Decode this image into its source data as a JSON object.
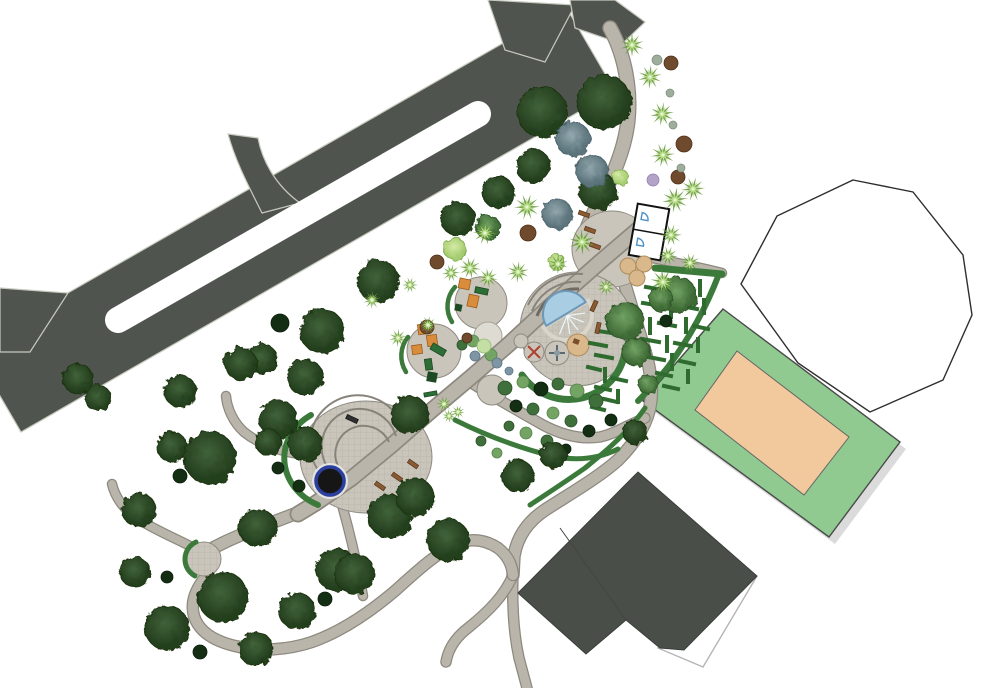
{
  "meta": {
    "image_type": "landscape-architecture site plan, top-down rendered park design",
    "visible_text": [],
    "features": [
      "divided road with median",
      "park entry path",
      "restroom pavilion",
      "picnic tables",
      "splash pool plaza with amphitheater steps",
      "spinner play circles",
      "sand circle",
      "two playground pads with climbers",
      "hedge maze garden",
      "shrub garden",
      "large oval plaza with round black pond",
      "small round plaza",
      "looping walking trails",
      "sports court (green with tan infield)",
      "large dark hip-roof building",
      "white parcel outline",
      "dense tree planting"
    ]
  },
  "colors": {
    "road": "#50544f",
    "road_edge": "#c6cabd",
    "path_fill": "#b9b5ab",
    "path_edge": "#8d897f",
    "plaza_fill": "#c9c5bb",
    "plaza_edge": "#8f8b82",
    "hedge": "#3c7a3c",
    "maze_wall": "#2f6b2f",
    "field_green": "#90ca90",
    "court_tan": "#f1c99d",
    "building_roof": "#4a4e49",
    "water": "#a9cde2",
    "water_edge": "#6d98b8",
    "pond": "#161616",
    "pond_ring": "#2b3f9e",
    "bench": "#8a5a33",
    "equip_orange": "#d88c3c",
    "equip_green": "#2c6e36",
    "tree_dark": "#2c4c28",
    "tree_medium": "#4d7d46",
    "tree_blue": "#6e858d",
    "palm": "#9ccb66",
    "white": "#ffffff"
  },
  "vegetation": {
    "trees": [
      [
        542,
        112,
        25,
        "d"
      ],
      [
        604,
        102,
        27,
        "d"
      ],
      [
        533,
        166,
        17,
        "d"
      ],
      [
        598,
        191,
        19,
        "d"
      ],
      [
        498,
        192,
        16,
        "d"
      ],
      [
        458,
        219,
        17,
        "d"
      ],
      [
        378,
        281,
        21,
        "d"
      ],
      [
        322,
        331,
        22,
        "d"
      ],
      [
        305,
        377,
        18,
        "d"
      ],
      [
        262,
        359,
        15,
        "d"
      ],
      [
        241,
        364,
        16,
        "d"
      ],
      [
        180,
        391,
        16,
        "d"
      ],
      [
        78,
        379,
        15,
        "d"
      ],
      [
        98,
        398,
        13,
        "d"
      ],
      [
        172,
        447,
        15,
        "d"
      ],
      [
        210,
        458,
        26,
        "d"
      ],
      [
        278,
        419,
        19,
        "d"
      ],
      [
        139,
        510,
        17,
        "d"
      ],
      [
        135,
        572,
        15,
        "d"
      ],
      [
        167,
        628,
        22,
        "d"
      ],
      [
        223,
        597,
        25,
        "d"
      ],
      [
        256,
        649,
        17,
        "d"
      ],
      [
        297,
        611,
        18,
        "d"
      ],
      [
        337,
        570,
        21,
        "d"
      ],
      [
        390,
        516,
        22,
        "d"
      ],
      [
        415,
        497,
        19,
        "d"
      ],
      [
        448,
        540,
        21,
        "d"
      ],
      [
        258,
        528,
        19,
        "d"
      ],
      [
        305,
        444,
        17,
        "d"
      ],
      [
        268,
        442,
        13,
        "d"
      ],
      [
        410,
        415,
        19,
        "d"
      ],
      [
        518,
        476,
        16,
        "d"
      ],
      [
        553,
        455,
        13,
        "d"
      ],
      [
        635,
        432,
        12,
        "d"
      ],
      [
        355,
        574,
        20,
        "d"
      ],
      [
        573,
        139,
        17,
        "b"
      ],
      [
        592,
        171,
        16,
        "b"
      ],
      [
        557,
        214,
        15,
        "b"
      ],
      [
        488,
        227,
        12,
        "m"
      ],
      [
        625,
        321,
        19,
        "m"
      ],
      [
        678,
        295,
        18,
        "m"
      ],
      [
        636,
        352,
        14,
        "m"
      ],
      [
        648,
        384,
        10,
        "m"
      ],
      [
        661,
        299,
        12,
        "m"
      ],
      [
        455,
        249,
        11,
        "l"
      ],
      [
        620,
        177,
        8,
        "l"
      ],
      [
        557,
        262,
        8,
        "l"
      ]
    ],
    "palms": [
      [
        632,
        45,
        12
      ],
      [
        650,
        77,
        12
      ],
      [
        662,
        114,
        12
      ],
      [
        663,
        155,
        12
      ],
      [
        527,
        207,
        13
      ],
      [
        485,
        233,
        12
      ],
      [
        470,
        268,
        11
      ],
      [
        488,
        278,
        10
      ],
      [
        582,
        242,
        13
      ],
      [
        558,
        264,
        10
      ],
      [
        518,
        272,
        11
      ],
      [
        675,
        200,
        13
      ],
      [
        693,
        189,
        12
      ],
      [
        671,
        235,
        11
      ],
      [
        668,
        256,
        10
      ],
      [
        690,
        263,
        10
      ],
      [
        663,
        282,
        13
      ],
      [
        606,
        287,
        9
      ],
      [
        372,
        300,
        9
      ],
      [
        398,
        338,
        9
      ],
      [
        428,
        325,
        9
      ],
      [
        451,
        273,
        9
      ],
      [
        410,
        285,
        8
      ],
      [
        444,
        404,
        8
      ],
      [
        458,
        412,
        7
      ],
      [
        449,
        416,
        7
      ]
    ],
    "shrubs": [
      [
        180,
        476,
        7,
        "dk"
      ],
      [
        278,
        468,
        6,
        "dk"
      ],
      [
        299,
        486,
        6,
        "dk"
      ],
      [
        167,
        577,
        6,
        "dk"
      ],
      [
        325,
        599,
        7,
        "dk"
      ],
      [
        200,
        652,
        7,
        "dk"
      ],
      [
        280,
        323,
        9,
        "dk"
      ],
      [
        666,
        321,
        6,
        "dk"
      ],
      [
        611,
        420,
        6,
        "dk"
      ],
      [
        589,
        431,
        6,
        "dk"
      ],
      [
        516,
        406,
        6,
        "dk"
      ],
      [
        566,
        449,
        5,
        "dk"
      ],
      [
        541,
        389,
        7,
        "dk"
      ],
      [
        505,
        388,
        7,
        "md"
      ],
      [
        558,
        384,
        6,
        "md"
      ],
      [
        596,
        401,
        7,
        "md"
      ],
      [
        533,
        409,
        6,
        "md"
      ],
      [
        571,
        421,
        6,
        "md"
      ],
      [
        509,
        426,
        5,
        "md"
      ],
      [
        547,
        441,
        6,
        "md"
      ],
      [
        481,
        441,
        5,
        "md"
      ],
      [
        462,
        345,
        5,
        "md"
      ],
      [
        523,
        382,
        6,
        "lt"
      ],
      [
        577,
        391,
        7,
        "lt"
      ],
      [
        553,
        413,
        6,
        "lt"
      ],
      [
        526,
        433,
        6,
        "lt"
      ],
      [
        497,
        453,
        5,
        "lt"
      ],
      [
        473,
        341,
        6,
        "lt"
      ],
      [
        491,
        355,
        6,
        "lt"
      ],
      [
        484,
        346,
        7,
        "pl"
      ],
      [
        497,
        363,
        5,
        "bl"
      ],
      [
        509,
        371,
        4,
        "bl"
      ],
      [
        475,
        356,
        5,
        "bl"
      ],
      [
        528,
        233,
        8,
        "br"
      ],
      [
        437,
        262,
        7,
        "br"
      ],
      [
        684,
        144,
        8,
        "br"
      ],
      [
        671,
        63,
        7,
        "br"
      ],
      [
        678,
        177,
        7,
        "br"
      ],
      [
        427,
        327,
        7,
        "br"
      ],
      [
        467,
        338,
        5,
        "br"
      ],
      [
        657,
        60,
        5,
        "gt"
      ],
      [
        670,
        93,
        4,
        "gt"
      ],
      [
        673,
        125,
        4,
        "gt"
      ],
      [
        681,
        168,
        4,
        "gt"
      ],
      [
        653,
        180,
        6,
        "pu"
      ]
    ]
  },
  "furniture": {
    "benches": [
      [
        584,
        214,
        20
      ],
      [
        590,
        230,
        20
      ],
      [
        595,
        246,
        20
      ],
      [
        594,
        306,
        -65
      ],
      [
        598,
        328,
        -78
      ],
      [
        380,
        486,
        35
      ],
      [
        397,
        477,
        35
      ],
      [
        413,
        464,
        35
      ]
    ],
    "dark_bench": [
      352,
      419,
      25
    ],
    "picnic_tables": [
      [
        628,
        266
      ],
      [
        644,
        264
      ],
      [
        637,
        278
      ]
    ]
  },
  "maze": {
    "walls": [
      [
        646,
        287,
        664,
        290
      ],
      [
        667,
        280,
        667,
        295
      ],
      [
        676,
        288,
        694,
        291
      ],
      [
        700,
        281,
        700,
        295
      ],
      [
        643,
        303,
        661,
        306
      ],
      [
        671,
        303,
        671,
        317
      ],
      [
        681,
        306,
        697,
        309
      ],
      [
        704,
        300,
        704,
        313
      ],
      [
        650,
        319,
        650,
        333
      ],
      [
        659,
        323,
        675,
        326
      ],
      [
        686,
        319,
        686,
        332
      ],
      [
        694,
        326,
        708,
        329
      ],
      [
        642,
        339,
        659,
        342
      ],
      [
        667,
        337,
        667,
        351
      ],
      [
        675,
        343,
        691,
        346
      ],
      [
        698,
        339,
        698,
        351
      ],
      [
        648,
        357,
        664,
        360
      ],
      [
        672,
        355,
        672,
        369
      ],
      [
        680,
        361,
        694,
        364
      ],
      [
        657,
        373,
        671,
        376
      ],
      [
        688,
        371,
        688,
        382
      ],
      [
        664,
        386,
        678,
        389
      ],
      [
        598,
        331,
        618,
        334
      ],
      [
        590,
        343,
        606,
        346
      ],
      [
        596,
        355,
        612,
        358
      ],
      [
        588,
        367,
        600,
        370
      ],
      [
        605,
        369,
        605,
        381
      ],
      [
        612,
        378,
        626,
        381
      ],
      [
        596,
        387,
        610,
        390
      ],
      [
        618,
        391,
        618,
        402
      ],
      [
        604,
        399,
        617,
        402
      ],
      [
        592,
        407,
        604,
        410
      ]
    ]
  }
}
